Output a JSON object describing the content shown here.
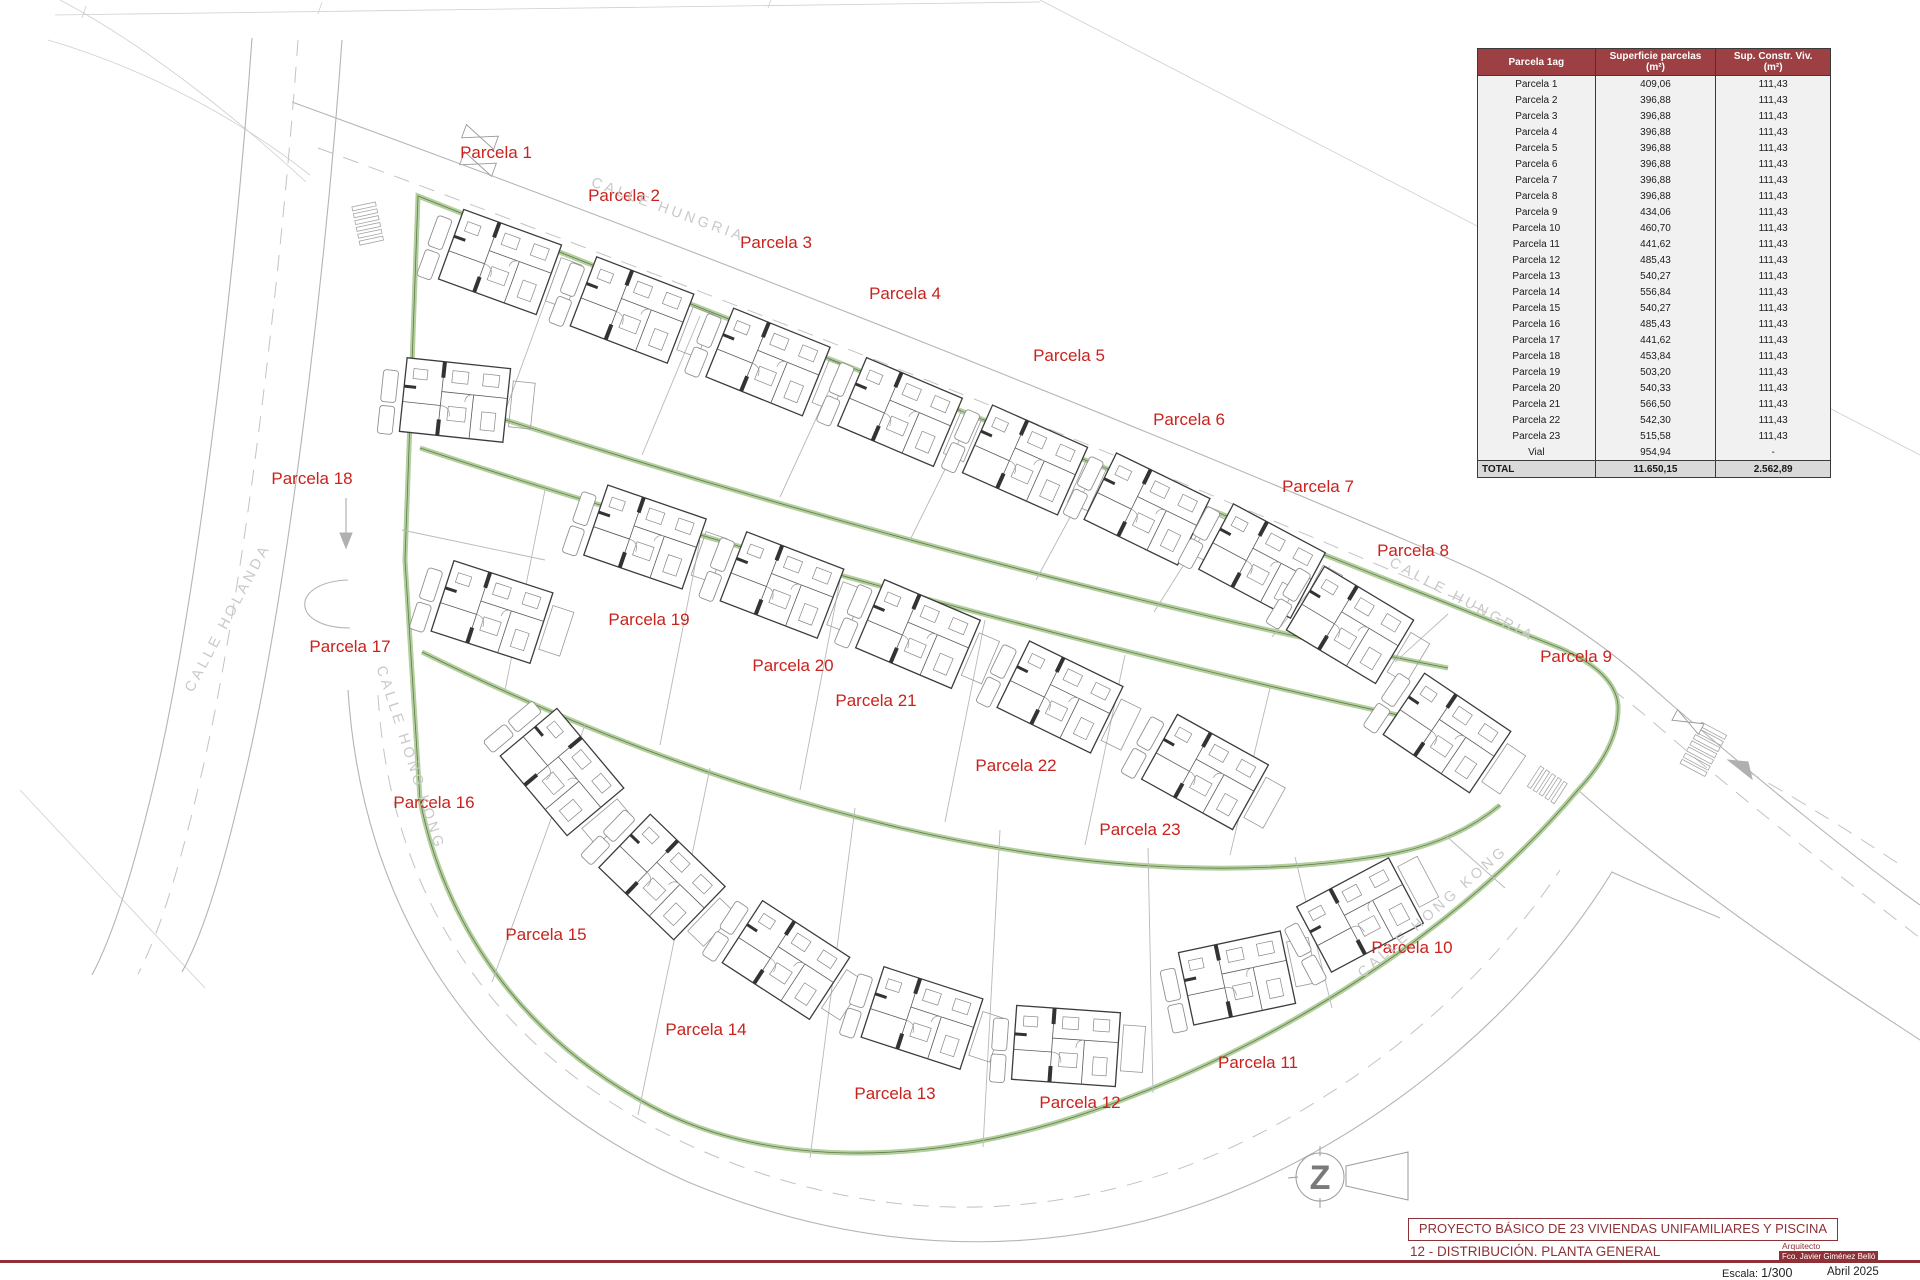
{
  "colors": {
    "parcel_label_red": "#c8231e",
    "maroon": "#8e3136",
    "table_header_bg": "#9c4044",
    "hedge_green": "#b3cf9e",
    "hedge_green_dark": "#5f7a4a",
    "road_gray": "#b4b4b4",
    "street_label_gray": "#c9c9c9"
  },
  "plan": {
    "north_arrow_letter": "Z",
    "parcel_labels": [
      {
        "label": "Parcela 1",
        "x": 496,
        "y": 153
      },
      {
        "label": "Parcela 2",
        "x": 624,
        "y": 196
      },
      {
        "label": "Parcela 3",
        "x": 776,
        "y": 243
      },
      {
        "label": "Parcela 4",
        "x": 905,
        "y": 294
      },
      {
        "label": "Parcela 5",
        "x": 1069,
        "y": 356
      },
      {
        "label": "Parcela 6",
        "x": 1189,
        "y": 420
      },
      {
        "label": "Parcela 7",
        "x": 1318,
        "y": 487
      },
      {
        "label": "Parcela 8",
        "x": 1413,
        "y": 551
      },
      {
        "label": "Parcela 9",
        "x": 1576,
        "y": 657
      },
      {
        "label": "Parcela 10",
        "x": 1412,
        "y": 948
      },
      {
        "label": "Parcela 11",
        "x": 1258,
        "y": 1063
      },
      {
        "label": "Parcela 12",
        "x": 1080,
        "y": 1103
      },
      {
        "label": "Parcela 13",
        "x": 895,
        "y": 1094
      },
      {
        "label": "Parcela 14",
        "x": 706,
        "y": 1030
      },
      {
        "label": "Parcela 15",
        "x": 546,
        "y": 935
      },
      {
        "label": "Parcela 16",
        "x": 434,
        "y": 803
      },
      {
        "label": "Parcela 17",
        "x": 350,
        "y": 647
      },
      {
        "label": "Parcela 18",
        "x": 312,
        "y": 479
      },
      {
        "label": "Parcela 19",
        "x": 649,
        "y": 620
      },
      {
        "label": "Parcela 20",
        "x": 793,
        "y": 666
      },
      {
        "label": "Parcela 21",
        "x": 876,
        "y": 701
      },
      {
        "label": "Parcela 22",
        "x": 1016,
        "y": 766
      },
      {
        "label": "Parcela 23",
        "x": 1140,
        "y": 830
      }
    ],
    "streets": [
      {
        "id": "hungria-top",
        "label": "CALLE HUNGRIA",
        "x": 668,
        "y": 210,
        "rot": 20
      },
      {
        "id": "hungria-right",
        "label": "CALLE HUNGRIA",
        "x": 1462,
        "y": 600,
        "rot": 28
      },
      {
        "id": "holanda",
        "label": "CALLE HOLANDA",
        "x": 228,
        "y": 618,
        "rot": -62
      },
      {
        "id": "hong-kong-left",
        "label": "CALLE HONG KONG",
        "x": 410,
        "y": 758,
        "rot": 72
      },
      {
        "id": "hong-kong-right",
        "label": "CALLE HONG KONG",
        "x": 1433,
        "y": 912,
        "rot": -41
      }
    ]
  },
  "table": {
    "headers": {
      "col1": "Parcela 1ag",
      "col2_line1": "Superficie parcelas",
      "col2_line2": "(m²)",
      "col3_line1": "Sup. Constr. Viv.",
      "col3_line2": "(m²)"
    },
    "rows": [
      [
        "Parcela 1",
        "409,06",
        "111,43"
      ],
      [
        "Parcela 2",
        "396,88",
        "111,43"
      ],
      [
        "Parcela 3",
        "396,88",
        "111,43"
      ],
      [
        "Parcela 4",
        "396,88",
        "111,43"
      ],
      [
        "Parcela 5",
        "396,88",
        "111,43"
      ],
      [
        "Parcela 6",
        "396,88",
        "111,43"
      ],
      [
        "Parcela 7",
        "396,88",
        "111,43"
      ],
      [
        "Parcela 8",
        "396,88",
        "111,43"
      ],
      [
        "Parcela 9",
        "434,06",
        "111,43"
      ],
      [
        "Parcela 10",
        "460,70",
        "111,43"
      ],
      [
        "Parcela 11",
        "441,62",
        "111,43"
      ],
      [
        "Parcela 12",
        "485,43",
        "111,43"
      ],
      [
        "Parcela 13",
        "540,27",
        "111,43"
      ],
      [
        "Parcela 14",
        "556,84",
        "111,43"
      ],
      [
        "Parcela 15",
        "540,27",
        "111,43"
      ],
      [
        "Parcela 16",
        "485,43",
        "111,43"
      ],
      [
        "Parcela 17",
        "441,62",
        "111,43"
      ],
      [
        "Parcela 18",
        "453,84",
        "111,43"
      ],
      [
        "Parcela 19",
        "503,20",
        "111,43"
      ],
      [
        "Parcela 20",
        "540,33",
        "111,43"
      ],
      [
        "Parcela 21",
        "566,50",
        "111,43"
      ],
      [
        "Parcela 22",
        "542,30",
        "111,43"
      ],
      [
        "Parcela 23",
        "515,58",
        "111,43"
      ],
      [
        "Vial",
        "954,94",
        "-"
      ]
    ],
    "total": [
      "TOTAL",
      "11.650,15",
      "2.562,89"
    ]
  },
  "title_block": {
    "project_title": "PROYECTO BÁSICO DE 23 VIVIENDAS UNIFAMILIARES Y PISCINA",
    "sheet": "12 - DISTRIBUCIÓN. PLANTA GENERAL",
    "architect_label": "Arquitecto",
    "architect_name": "Fco. Javier Giménez Belló",
    "scale_label": "Escala:",
    "scale_value": "1/300",
    "date": "Abril 2025"
  }
}
